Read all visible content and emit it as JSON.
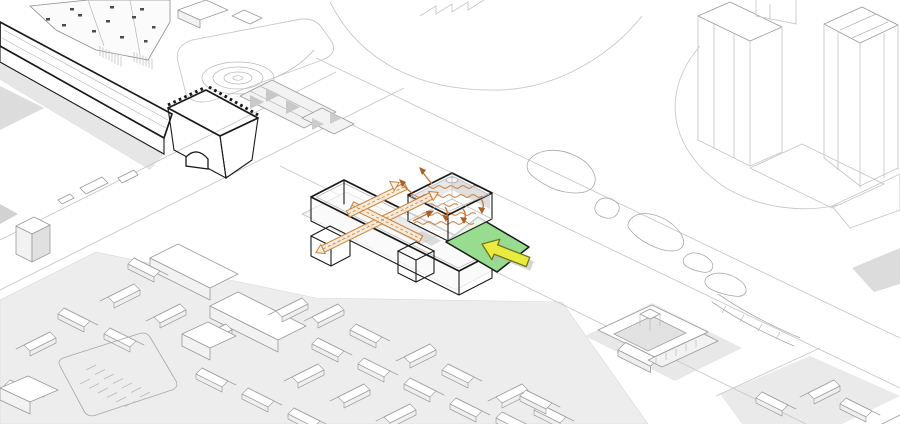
{
  "canvas": {
    "width": 900,
    "height": 424,
    "background": "#ffffff"
  },
  "diagram": {
    "type": "architectural-axonometric-site-diagram",
    "colors": {
      "plaza_green": "#98DC90",
      "bold_outline": "#1A1A1A",
      "arrow_yellow": "#E9EC3E",
      "arrow_yellow_stroke": "#6E7520",
      "arrow_shadow": "#B9BDB4",
      "path_orange": "#C8803E",
      "path_fill": "#F8ECD8",
      "airflow_orange": "#C67A3A",
      "arrowhead_dark": "#A85F28",
      "wall_top": "#D6D6D6",
      "wall_front": "#C2C2C2",
      "gate_top": "#DCDCDC",
      "gate_front": "#CDCDCD",
      "gate_side": "#C0C0C0",
      "window_dark": "#4C4C4C",
      "ground_shade": "#EDEDED"
    },
    "elements": {
      "city_wall": "city-wall",
      "gate_tower": "gate-tower",
      "museum": "museum-building",
      "spiral_park": "spiral-park",
      "terraced_plaza": "terraced-plaza",
      "residential_towers": "residential-towers",
      "median_park": "median-park-islands",
      "village": "village-houses",
      "parking": "parking-lot",
      "courtyard_complex": "courtyard-complex",
      "footbridge": "footbridge",
      "bar_building": "feature-bar-building",
      "exhibition_hall": "exhibition-hall",
      "circulation_path": "circulation-path",
      "airflow_arrows": "airflow-arrows",
      "entry_plaza": "entry-plaza",
      "entry_arrow": "entry-arrow"
    }
  }
}
